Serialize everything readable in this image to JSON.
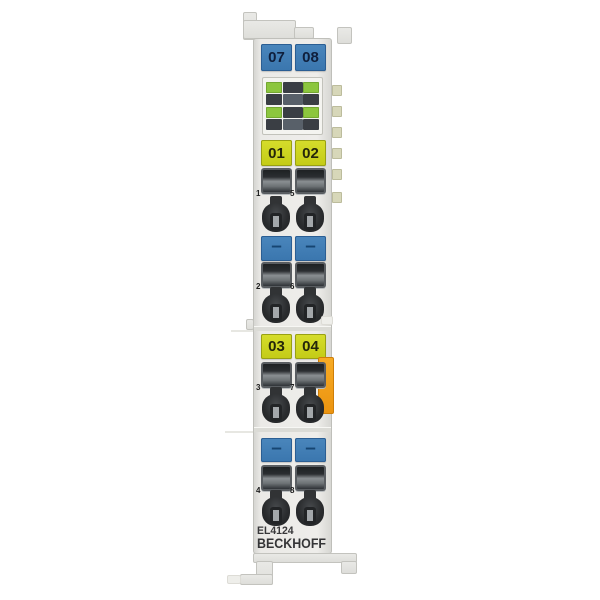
{
  "product": {
    "model": "EL4124",
    "brand": "BECKHOFF",
    "description": "Beckhoff EtherCAT analog output terminal product photo"
  },
  "labels": {
    "top": [
      "07",
      "08"
    ],
    "ch12": [
      "01",
      "02"
    ],
    "minus1": [
      "–",
      "–"
    ],
    "ch34": [
      "03",
      "04"
    ],
    "minus2": [
      "–",
      "–"
    ]
  },
  "terminal_numbers": {
    "rows": [
      [
        "1",
        "5"
      ],
      [
        "2",
        "6"
      ],
      [
        "3",
        "7"
      ],
      [
        "4",
        "8"
      ]
    ]
  },
  "leds": {
    "rows": [
      [
        "green",
        "dark",
        "green"
      ],
      [
        "dark",
        "mid",
        "dark"
      ],
      [
        "green",
        "dark",
        "green"
      ],
      [
        "dark",
        "mid",
        "dark"
      ]
    ]
  },
  "colors": {
    "label_blue": "#3e7cb4",
    "label_yellow": "#ccd41f",
    "led_green": "#8cc63e",
    "orange_tab": "#f2a01d",
    "body_gray": "#ebebe8",
    "background": "#ffffff"
  }
}
